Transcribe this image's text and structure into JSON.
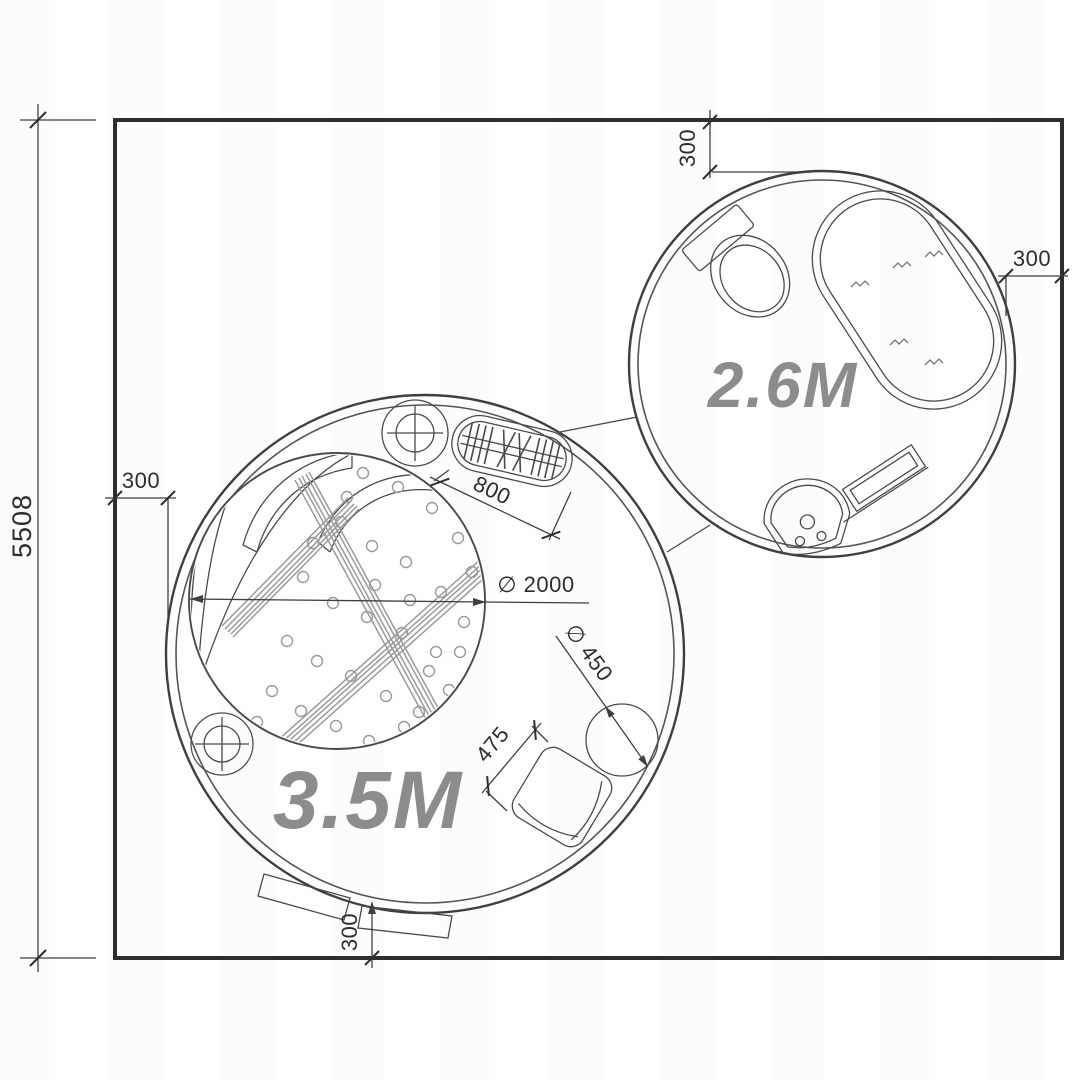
{
  "plan": {
    "site_height": "5508",
    "clearance_top": "300",
    "clearance_right": "300",
    "clearance_left": "300",
    "entrance_clearance": "300",
    "radiator_length": "800",
    "bed_diameter": "∅ 2000",
    "side_table_diameter": "∅ 450",
    "armchair_width": "475",
    "dome_large_label": "3.5M",
    "dome_small_label": "2.6M"
  },
  "colors": {
    "line": "#3a3a3a",
    "label_gray": "#8c8c8c",
    "background": "#ffffff"
  }
}
